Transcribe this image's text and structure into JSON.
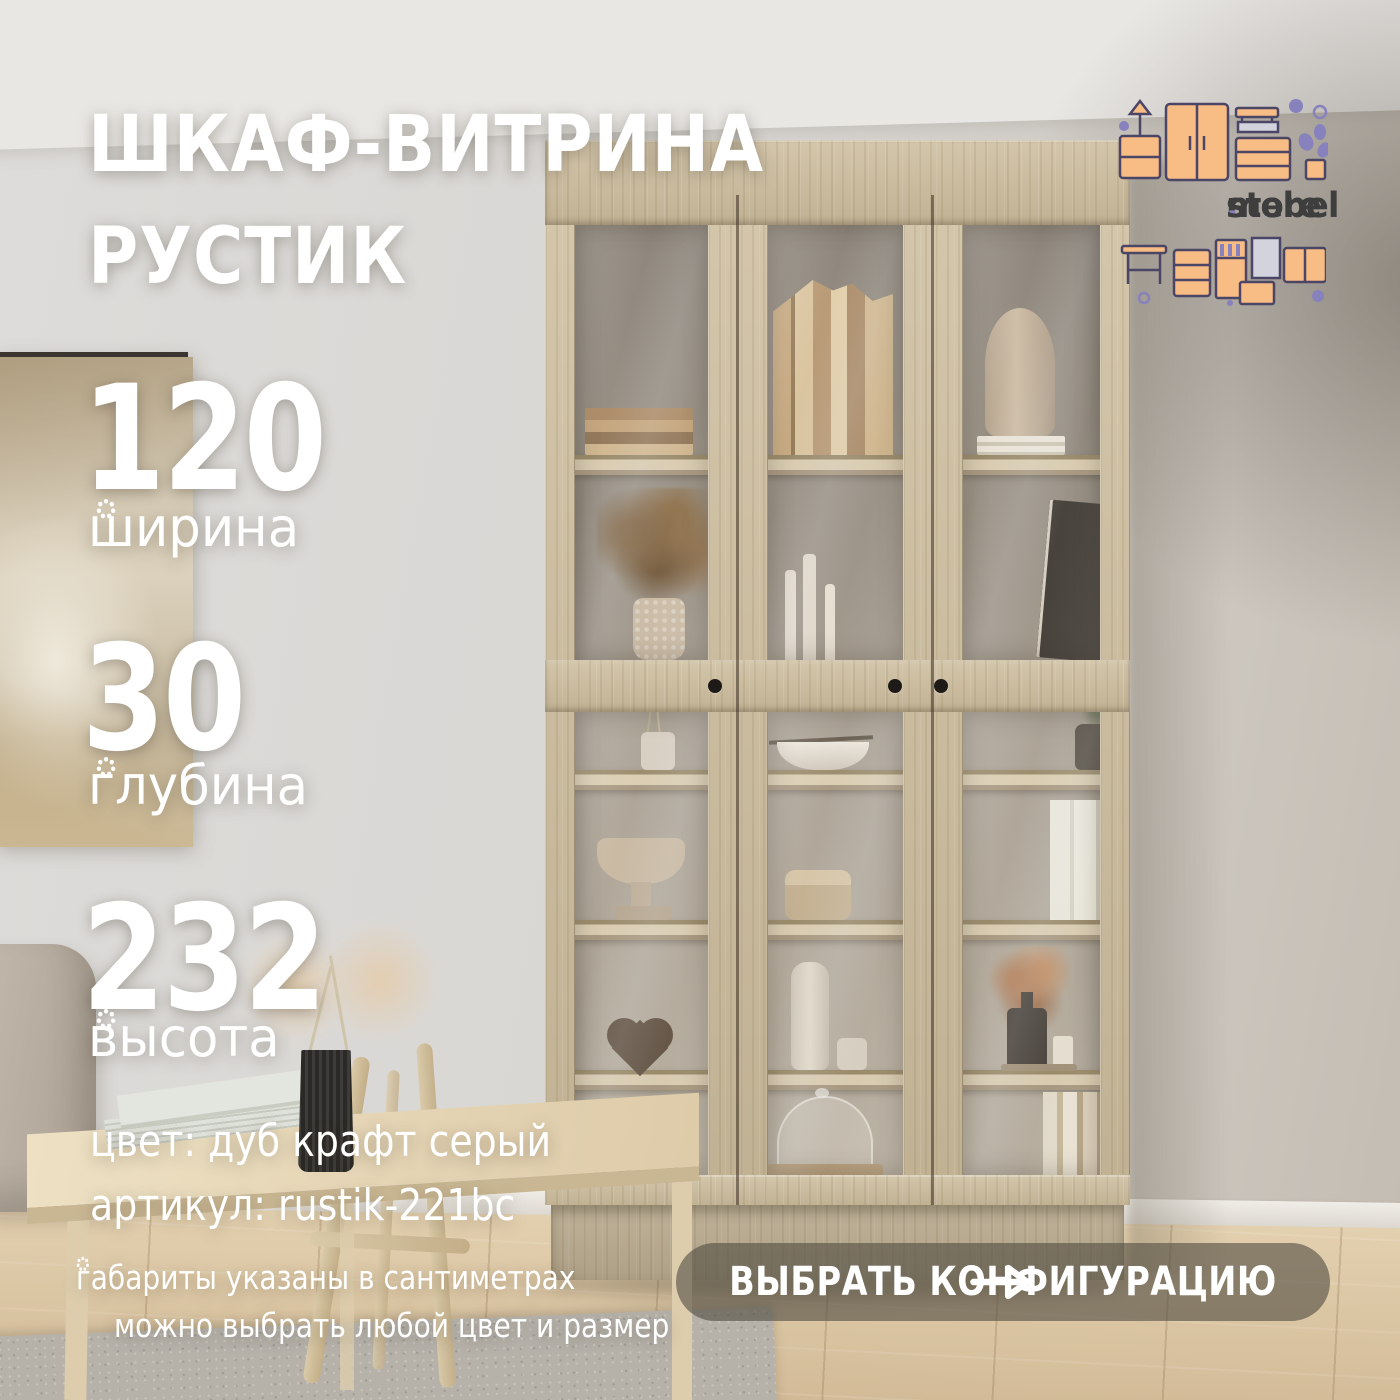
{
  "brand": {
    "name": "mebel store",
    "word1": "mebel",
    "separator": ".",
    "word2": "store"
  },
  "product": {
    "title_line1": "ШКАФ-ВИТРИНА",
    "title_line2": "РУСТИК"
  },
  "dimensions": [
    {
      "value": "120",
      "label": "ширина"
    },
    {
      "value": "30",
      "label": "глубина"
    },
    {
      "value": "232",
      "label": "высота"
    }
  ],
  "details": {
    "color": "цвет: дуб крафт серый",
    "sku": "артикул: rustik-221bc"
  },
  "footnote": {
    "line1": "габариты указаны в сантиметрах",
    "line2": "можно выбрать любой цвет и размер"
  },
  "cta": {
    "label": "ВЫБРАТЬ КОНФИГУРАЦИЮ"
  },
  "colors": {
    "wall": "#d8d6d3",
    "wood": "#cfc0a2",
    "floor": "#d9c4a3",
    "accent_orange": "#f7bd85",
    "accent_purple": "#8781bd",
    "logo_text": "#3f3e3e",
    "cta_bg": "rgba(84,79,68,0.62)",
    "text": "#ffffff"
  }
}
